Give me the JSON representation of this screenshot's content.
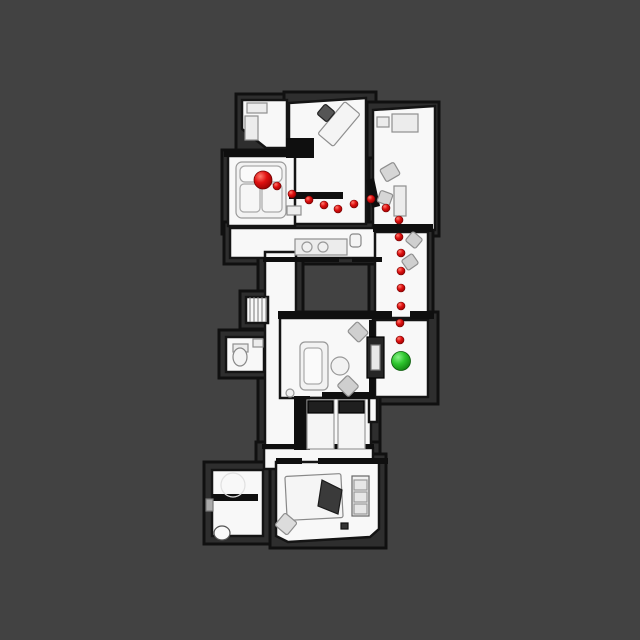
{
  "scene": {
    "title": "top-down-floorplan-navigation-view",
    "background_color": "#424242",
    "canvas": {
      "width": 640,
      "height": 640
    }
  },
  "map": {
    "colors": {
      "void_fill": "#2e2e2e",
      "void_stroke": "#101010",
      "floor_fill": "#f8f8f8",
      "floor_stroke": "#141414",
      "wall_fill": "#0f0f0f",
      "furniture_fill": "#ececec",
      "furniture_stroke": "#8f8f8f",
      "dark_item_fill": "#262626"
    },
    "base_blocks": [
      {
        "name": "base-top-left",
        "type": "rect",
        "x": 236,
        "y": 94,
        "w": 136,
        "h": 62
      },
      {
        "name": "base-top-mid",
        "type": "rect",
        "x": 284,
        "y": 92,
        "w": 92,
        "h": 140
      },
      {
        "name": "base-top-right",
        "type": "rect",
        "x": 367,
        "y": 102,
        "w": 72,
        "h": 134
      },
      {
        "name": "base-living",
        "type": "rect",
        "x": 222,
        "y": 150,
        "w": 78,
        "h": 84
      },
      {
        "name": "base-right-corridor",
        "type": "rect",
        "x": 369,
        "y": 158,
        "w": 64,
        "h": 166
      },
      {
        "name": "base-hall",
        "type": "rect",
        "x": 224,
        "y": 222,
        "w": 162,
        "h": 42
      },
      {
        "name": "base-mid-corridor",
        "type": "rect",
        "x": 258,
        "y": 246,
        "w": 45,
        "h": 210
      },
      {
        "name": "base-stairs",
        "type": "rect",
        "x": 240,
        "y": 291,
        "w": 32,
        "h": 38
      },
      {
        "name": "base-toilet-room",
        "type": "rect",
        "x": 219,
        "y": 330,
        "w": 48,
        "h": 48
      },
      {
        "name": "base-mid-living",
        "type": "rect",
        "x": 274,
        "y": 312,
        "w": 164,
        "h": 92
      },
      {
        "name": "base-twin-room",
        "type": "rect",
        "x": 292,
        "y": 392,
        "w": 88,
        "h": 68
      },
      {
        "name": "base-corridor-2",
        "type": "rect",
        "x": 256,
        "y": 442,
        "w": 124,
        "h": 33
      },
      {
        "name": "base-bottom-bedroom",
        "type": "rect",
        "x": 270,
        "y": 454,
        "w": 116,
        "h": 94
      },
      {
        "name": "base-bottom-left",
        "type": "rect",
        "x": 204,
        "y": 462,
        "w": 66,
        "h": 82
      }
    ],
    "floors": [
      {
        "name": "floor-closet",
        "type": "poly",
        "points": "242,100 287,100 287,148 266,148 242,129"
      },
      {
        "name": "floor-top-mid-room",
        "type": "poly",
        "points": "289,103 366,98 366,224 289,224"
      },
      {
        "name": "floor-top-right-room",
        "type": "poly",
        "points": "373,110 435,106 435,230 373,230"
      },
      {
        "name": "floor-living-room",
        "type": "rect",
        "x": 228,
        "y": 156,
        "w": 67,
        "h": 70
      },
      {
        "name": "floor-hall",
        "type": "poly",
        "points": "230,228 381,228 381,258 230,258"
      },
      {
        "name": "floor-right-corridor",
        "type": "rect",
        "x": 375,
        "y": 232,
        "w": 53,
        "h": 86
      },
      {
        "name": "floor-mid-corridor",
        "type": "rect",
        "x": 265,
        "y": 252,
        "w": 31,
        "h": 200
      },
      {
        "name": "floor-stairs",
        "type": "rect",
        "x": 246,
        "y": 297,
        "w": 22,
        "h": 26
      },
      {
        "name": "floor-toilet-room",
        "type": "rect",
        "x": 226,
        "y": 337,
        "w": 38,
        "h": 35
      },
      {
        "name": "floor-mid-living",
        "type": "rect",
        "x": 280,
        "y": 318,
        "w": 93,
        "h": 80
      },
      {
        "name": "floor-green-room",
        "type": "rect",
        "x": 375,
        "y": 320,
        "w": 53,
        "h": 77
      },
      {
        "name": "floor-twin-room",
        "type": "rect",
        "x": 308,
        "y": 398,
        "w": 63,
        "h": 53
      },
      {
        "name": "floor-sliver",
        "type": "rect",
        "x": 369,
        "y": 398,
        "w": 8,
        "h": 24
      },
      {
        "name": "floor-corridor-2",
        "type": "rect",
        "x": 264,
        "y": 448,
        "w": 109,
        "h": 21
      },
      {
        "name": "floor-bottom-bedroom",
        "type": "poly",
        "points": "276,462 379,462 379,529 370,537 288,542 276,536"
      },
      {
        "name": "floor-bottom-left-room",
        "type": "rect",
        "x": 212,
        "y": 470,
        "w": 51,
        "h": 66
      }
    ],
    "walls": [
      {
        "name": "wall-living-top",
        "type": "rect",
        "x": 224,
        "y": 149,
        "w": 80,
        "h": 8
      },
      {
        "name": "wall-step-block",
        "type": "rect",
        "x": 286,
        "y": 138,
        "w": 28,
        "h": 20
      },
      {
        "name": "wall-top-mid-bottom",
        "type": "rect",
        "x": 289,
        "y": 192,
        "w": 54,
        "h": 7
      },
      {
        "name": "wall-top-right-bottom",
        "type": "rect",
        "x": 373,
        "y": 224,
        "w": 60,
        "h": 8
      },
      {
        "name": "wall-angled-divider",
        "type": "poly",
        "points": "366,180 374,178 380,206 372,208"
      },
      {
        "name": "wall-hall-bottom-left",
        "type": "rect",
        "x": 263,
        "y": 257,
        "w": 76,
        "h": 5
      },
      {
        "name": "wall-hall-bottom-right",
        "type": "rect",
        "x": 352,
        "y": 257,
        "w": 30,
        "h": 5
      },
      {
        "name": "wall-mid-living-top-left",
        "type": "rect",
        "x": 278,
        "y": 311,
        "w": 114,
        "h": 8
      },
      {
        "name": "wall-mid-living-top-right",
        "type": "rect",
        "x": 410,
        "y": 311,
        "w": 24,
        "h": 8
      },
      {
        "name": "wall-green-divider",
        "type": "rect",
        "x": 369,
        "y": 320,
        "w": 6,
        "h": 78
      },
      {
        "name": "wall-twin-left-block",
        "type": "rect",
        "x": 294,
        "y": 396,
        "w": 16,
        "h": 54
      },
      {
        "name": "wall-twin-top",
        "type": "rect",
        "x": 322,
        "y": 392,
        "w": 52,
        "h": 7
      },
      {
        "name": "wall-corridor2-top",
        "type": "rect",
        "x": 262,
        "y": 444,
        "w": 112,
        "h": 5
      },
      {
        "name": "wall-bottom-bed-top-a",
        "type": "rect",
        "x": 276,
        "y": 458,
        "w": 26,
        "h": 6
      },
      {
        "name": "wall-bottom-bed-top-b",
        "type": "rect",
        "x": 318,
        "y": 458,
        "w": 70,
        "h": 6
      },
      {
        "name": "wall-bottom-left-divider",
        "type": "rect",
        "x": 212,
        "y": 494,
        "w": 46,
        "h": 7
      }
    ],
    "furniture": [
      {
        "name": "closet-shelf-a",
        "type": "rect",
        "x": 247,
        "y": 103,
        "w": 20,
        "h": 10
      },
      {
        "name": "closet-shelf-b",
        "type": "rect",
        "x": 245,
        "y": 116,
        "w": 13,
        "h": 24
      },
      {
        "name": "desk-top-mid",
        "type": "rotrect",
        "cx": 339,
        "cy": 124,
        "w": 20,
        "h": 42,
        "rot": 40,
        "fill": "#f4f4f4"
      },
      {
        "name": "desk-chair",
        "type": "rotrect",
        "cx": 326,
        "cy": 113,
        "w": 13,
        "h": 13,
        "rot": 40,
        "fill": "#555555",
        "stroke": "#222222"
      },
      {
        "name": "side-table-top-right",
        "type": "rect",
        "x": 377,
        "y": 117,
        "w": 12,
        "h": 10
      },
      {
        "name": "desk-top-right",
        "type": "rect",
        "x": 392,
        "y": 114,
        "w": 26,
        "h": 18
      },
      {
        "name": "chair-top-right-a",
        "type": "rotrect",
        "cx": 390,
        "cy": 172,
        "w": 16,
        "h": 14,
        "rot": -30,
        "fill": "#d6d6d6"
      },
      {
        "name": "chair-top-right-b",
        "type": "rotrect",
        "cx": 385,
        "cy": 198,
        "w": 13,
        "h": 12,
        "rot": 20,
        "fill": "#d6d6d6"
      },
      {
        "name": "cabinet-top-right",
        "type": "rect",
        "x": 394,
        "y": 186,
        "w": 12,
        "h": 30
      },
      {
        "name": "chair-corridor-a",
        "type": "rotrect",
        "cx": 414,
        "cy": 240,
        "w": 13,
        "h": 12,
        "rot": 40,
        "fill": "#cfcfcf"
      },
      {
        "name": "chair-corridor-b",
        "type": "rotrect",
        "cx": 410,
        "cy": 262,
        "w": 13,
        "h": 12,
        "rot": -35,
        "fill": "#cfcfcf"
      },
      {
        "name": "couch-living",
        "type": "rrect",
        "x": 236,
        "y": 162,
        "w": 50,
        "h": 56,
        "rx": 6,
        "fill": "#f2f2f2",
        "stroke": "#9a9a9a"
      },
      {
        "name": "couch-back-cushion",
        "type": "rrect",
        "x": 240,
        "y": 166,
        "w": 42,
        "h": 16,
        "rx": 5,
        "fill": "#fafafa",
        "stroke": "#aaaaaa"
      },
      {
        "name": "couch-seat-a",
        "type": "rrect",
        "x": 240,
        "y": 184,
        "w": 20,
        "h": 28,
        "rx": 4,
        "fill": "#f6f6f6",
        "stroke": "#aaaaaa"
      },
      {
        "name": "couch-seat-b",
        "type": "rrect",
        "x": 262,
        "y": 184,
        "w": 20,
        "h": 28,
        "rx": 4,
        "fill": "#f6f6f6",
        "stroke": "#aaaaaa"
      },
      {
        "name": "coffee-table",
        "type": "rect",
        "x": 287,
        "y": 206,
        "w": 14,
        "h": 9
      },
      {
        "name": "kitchen-counter",
        "type": "rect",
        "x": 295,
        "y": 239,
        "w": 52,
        "h": 16
      },
      {
        "name": "sink-bowl-a",
        "type": "circle",
        "cx": 307,
        "cy": 247,
        "r": 5,
        "fill": "#f0f0f0",
        "stroke": "#999999"
      },
      {
        "name": "sink-bowl-b",
        "type": "circle",
        "cx": 323,
        "cy": 247,
        "r": 5,
        "fill": "#f0f0f0",
        "stroke": "#999999"
      },
      {
        "name": "toilet-nook",
        "type": "rrect",
        "x": 350,
        "y": 234,
        "w": 11,
        "h": 13,
        "rx": 3,
        "fill": "#f4f4f4",
        "stroke": "#888888"
      },
      {
        "name": "toilet-mid-left-tank",
        "type": "rect",
        "x": 233,
        "y": 344,
        "w": 15,
        "h": 8
      },
      {
        "name": "toilet-mid-left-bowl",
        "type": "ellipse",
        "cx": 240,
        "cy": 357,
        "rx": 7,
        "ry": 9,
        "fill": "#f4f4f4",
        "stroke": "#888888"
      },
      {
        "name": "sink-mid-left",
        "type": "rect",
        "x": 253,
        "y": 339,
        "w": 10,
        "h": 8
      },
      {
        "name": "sofa-mid-living",
        "type": "rrect",
        "x": 300,
        "y": 342,
        "w": 28,
        "h": 48,
        "rx": 5,
        "fill": "#f2f2f2",
        "stroke": "#999999"
      },
      {
        "name": "sofa-mid-cushion",
        "type": "rrect",
        "x": 304,
        "y": 348,
        "w": 18,
        "h": 36,
        "rx": 4,
        "fill": "#fafafa",
        "stroke": "#aaaaaa"
      },
      {
        "name": "round-table",
        "type": "circle",
        "cx": 340,
        "cy": 366,
        "r": 9,
        "fill": "#f2f2f2",
        "stroke": "#999999"
      },
      {
        "name": "stool",
        "type": "circle",
        "cx": 290,
        "cy": 393,
        "r": 4,
        "fill": "#f0f0f0",
        "stroke": "#999999"
      },
      {
        "name": "chair-mid-a",
        "type": "rotrect",
        "cx": 358,
        "cy": 332,
        "w": 16,
        "h": 14,
        "rot": 45,
        "fill": "#cfcfcf"
      },
      {
        "name": "chair-mid-b",
        "type": "rotrect",
        "cx": 348,
        "cy": 386,
        "w": 16,
        "h": 15,
        "rot": 45,
        "fill": "#cfcfcf"
      },
      {
        "name": "tv-stand-dark",
        "type": "rect",
        "x": 367,
        "y": 337,
        "w": 17,
        "h": 41,
        "fill": "#262626",
        "stroke": "#000000"
      },
      {
        "name": "tv-stand-inner",
        "type": "rect",
        "x": 371,
        "y": 345,
        "w": 9,
        "h": 25,
        "fill": "#e8e8e8",
        "stroke": "#777777"
      },
      {
        "name": "twin-bed-a",
        "type": "rect",
        "x": 307,
        "y": 400,
        "w": 27,
        "h": 49,
        "fill": "#f5f5f5",
        "stroke": "#999999"
      },
      {
        "name": "twin-bed-a-pillow",
        "type": "rect",
        "x": 308,
        "y": 401,
        "w": 25,
        "h": 12,
        "fill": "#1f1f1f",
        "stroke": "#000000"
      },
      {
        "name": "twin-bed-b",
        "type": "rect",
        "x": 338,
        "y": 400,
        "w": 27,
        "h": 49,
        "fill": "#f5f5f5",
        "stroke": "#999999"
      },
      {
        "name": "twin-bed-b-pillow",
        "type": "rect",
        "x": 339,
        "y": 401,
        "w": 25,
        "h": 12,
        "fill": "#1f1f1f",
        "stroke": "#000000"
      },
      {
        "name": "big-bed",
        "type": "rotrect",
        "cx": 314,
        "cy": 497,
        "w": 56,
        "h": 44,
        "rot": -3,
        "fill": "#f5f5f5",
        "stroke": "#888888"
      },
      {
        "name": "big-bed-blanket",
        "type": "poly",
        "points": "322,480 342,490 338,514 318,506",
        "fill": "#3a3a3a",
        "stroke": "#1a1a1a"
      },
      {
        "name": "dresser",
        "type": "rect",
        "x": 352,
        "y": 476,
        "w": 17,
        "h": 40,
        "fill": "#f0f0f0",
        "stroke": "#666666"
      },
      {
        "name": "dresser-drawer-a",
        "type": "rect",
        "x": 354,
        "y": 480,
        "w": 13,
        "h": 10,
        "fill": "#e6e6e6",
        "stroke": "#999999"
      },
      {
        "name": "dresser-drawer-b",
        "type": "rect",
        "x": 354,
        "y": 492,
        "w": 13,
        "h": 10,
        "fill": "#e6e6e6",
        "stroke": "#999999"
      },
      {
        "name": "dresser-drawer-c",
        "type": "rect",
        "x": 354,
        "y": 504,
        "w": 13,
        "h": 10,
        "fill": "#e6e6e6",
        "stroke": "#999999"
      },
      {
        "name": "nightstand-diamond",
        "type": "rotrect",
        "cx": 286,
        "cy": 524,
        "w": 16,
        "h": 16,
        "rot": 40,
        "fill": "#dcdcdc"
      },
      {
        "name": "rug-ghost",
        "type": "circle",
        "cx": 233,
        "cy": 485,
        "r": 12,
        "fill": "none",
        "stroke": "#e0e0e0"
      },
      {
        "name": "small-dark-item",
        "type": "rect",
        "x": 341,
        "y": 523,
        "w": 7,
        "h": 6,
        "fill": "#333333",
        "stroke": "#111111"
      },
      {
        "name": "toilet-bottom-left",
        "type": "ellipse",
        "cx": 222,
        "cy": 533,
        "rx": 8,
        "ry": 7,
        "fill": "#fafafa",
        "stroke": "#555555"
      },
      {
        "name": "wall-tab",
        "type": "rect",
        "x": 206,
        "y": 499,
        "w": 7,
        "h": 12,
        "fill": "#aaaaaa",
        "stroke": "#777777"
      }
    ],
    "stairs": {
      "name": "stairs-treads",
      "x1": 246,
      "x2": 268,
      "y_top": 297,
      "y_bottom": 322,
      "tread_xs": [
        250,
        254,
        258,
        262,
        266
      ],
      "stroke": "#777777"
    }
  },
  "path": {
    "dot_radius": 4,
    "dot_color_core": "#e01010",
    "dot_color_highlight": "#ff7b6e",
    "dot_color_rim": "#8f0000",
    "waypoints": [
      [
        277,
        186
      ],
      [
        292,
        194
      ],
      [
        309,
        200
      ],
      [
        324,
        205
      ],
      [
        338,
        209
      ],
      [
        354,
        204
      ],
      [
        371,
        199
      ],
      [
        386,
        208
      ],
      [
        399,
        220
      ],
      [
        399,
        237
      ],
      [
        401,
        253
      ],
      [
        401,
        271
      ],
      [
        401,
        288
      ],
      [
        401,
        306
      ],
      [
        400,
        323
      ],
      [
        400,
        340
      ]
    ],
    "start_marker": {
      "name": "start-marker",
      "x": 263,
      "y": 180,
      "radius": 9,
      "color_core": "#e01010",
      "color_highlight": "#ff7b6e",
      "color_rim": "#8f0000"
    },
    "goal_marker": {
      "name": "goal-marker",
      "x": 401,
      "y": 361,
      "radius": 9.5,
      "color_core": "#2ec62e",
      "color_highlight": "#8af28a",
      "color_rim": "#0f7a0f"
    }
  }
}
